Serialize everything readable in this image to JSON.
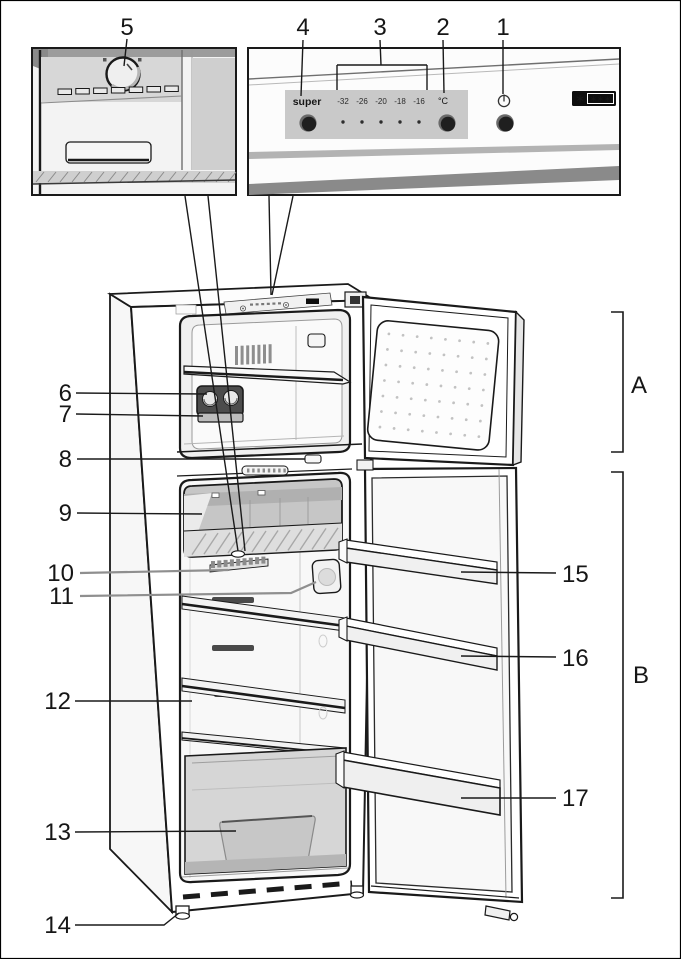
{
  "callouts": {
    "c1": "1",
    "c2": "2",
    "c3": "3",
    "c4": "4",
    "c5": "5",
    "c6": "6",
    "c7": "7",
    "c8": "8",
    "c9": "9",
    "c10": "10",
    "c11": "11",
    "c12": "12",
    "c13": "13",
    "c14": "14",
    "c15": "15",
    "c16": "16",
    "c17": "17",
    "cA": "A",
    "cB": "B"
  },
  "control_panel": {
    "super_label": "super",
    "temperature_scale": [
      "-32",
      "-26",
      "-20",
      "-18",
      "-16"
    ],
    "unit_label": "°C",
    "freezer_rating_single": "∗",
    "freezer_rating_triple": "∗∗∗"
  },
  "icons": {
    "power_icon": "power-symbol-circle-with-bar",
    "knob_icon": "thermostat-dial"
  },
  "colors": {
    "line": "#1a1a1a",
    "panel_gray": "#c9c9c9",
    "band_dark": "#8a8a8a",
    "badge_black": "#0d0d0d",
    "button_dark": "#1f1f1f",
    "shade_mid": "#c6c6c6"
  }
}
